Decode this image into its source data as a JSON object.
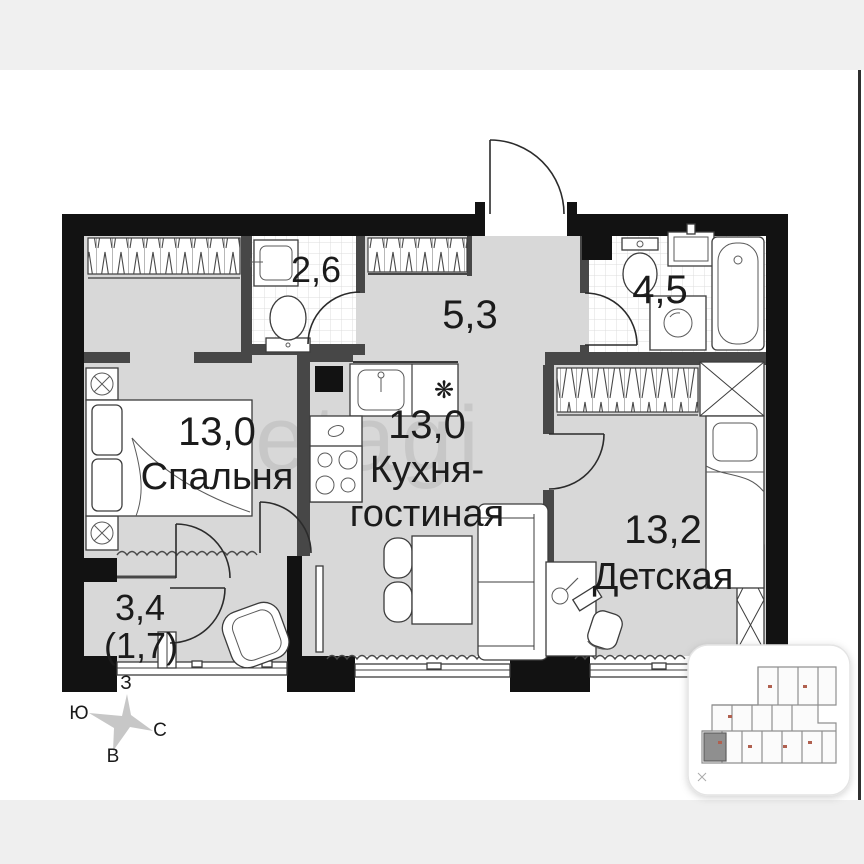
{
  "plan": {
    "watermark": "etagi",
    "rooms": {
      "bedroom": {
        "area": "13,0",
        "name": "Спальня"
      },
      "kitchen": {
        "area": "13,0",
        "name_line1": "Кухня-",
        "name_line2": "гостиная"
      },
      "children": {
        "area": "13,2",
        "name": "Детская"
      },
      "hallway": {
        "area": "5,3"
      },
      "wc": {
        "area": "2,6"
      },
      "bath": {
        "area": "4,5"
      },
      "loggia": {
        "area": "3,4",
        "area_secondary": "(1,7)"
      }
    },
    "compass": {
      "west": "З",
      "south": "Ю",
      "north": "С",
      "east": "В"
    },
    "colors": {
      "floor": "#d8d8d8",
      "wall": "#121212",
      "inner_wall": "#474747",
      "tile_line": "#dcdcdc"
    }
  },
  "minimap": {
    "highlight_color": "#8f8f8f"
  }
}
